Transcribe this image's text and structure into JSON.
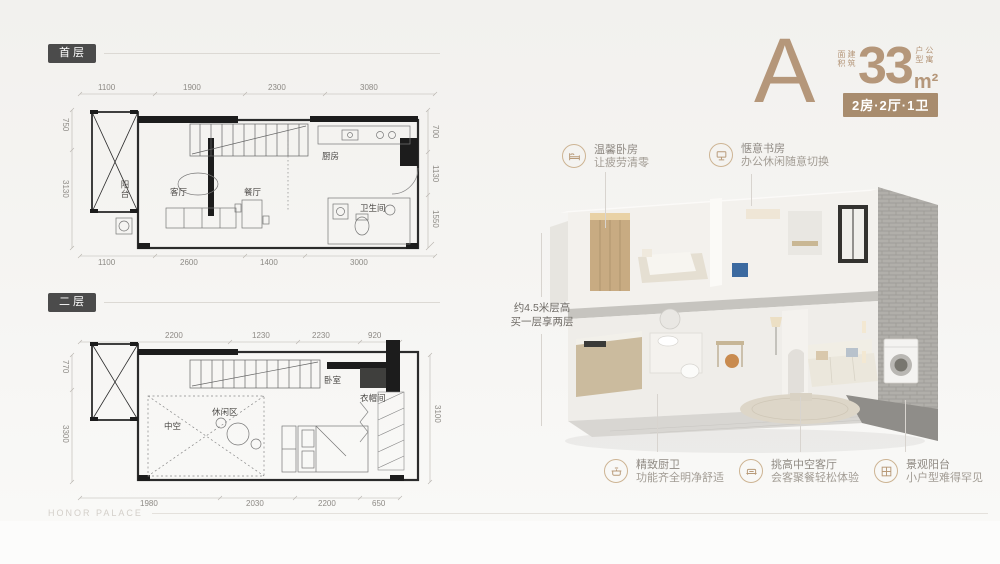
{
  "header": {
    "plan_letter": "A",
    "area_label_vertical": "建筑面积",
    "area_value": "33",
    "area_unit": "m²",
    "type_label_vertical": "公寓户型",
    "unit_badge": "2房·2厅·1卫"
  },
  "floor_plans": [
    {
      "badge": "首层",
      "room_labels": {
        "balcony": "阳台",
        "living": "客厅",
        "dining": "餐厅",
        "kitchen": "厨房",
        "bath": "卫生间"
      },
      "dims_top": [
        "1100",
        "1900",
        "2300",
        "3080"
      ],
      "dims_bottom": [
        "1100",
        "2600",
        "1400",
        "3000"
      ],
      "dims_left": [
        "750",
        "3130"
      ],
      "dims_right": [
        "700",
        "1130",
        "1550"
      ]
    },
    {
      "badge": "二层",
      "room_labels": {
        "void": "中空",
        "leisure": "休闲区",
        "bedroom": "卧室",
        "cloak": "衣帽间"
      },
      "dims_top": [
        "2200",
        "1230",
        "2230",
        "920"
      ],
      "dims_bottom": [
        "1980",
        "2030",
        "2200",
        "650"
      ],
      "dims_left": [
        "770",
        "3300"
      ],
      "dims_right": [
        "3100"
      ]
    }
  ],
  "center_note": {
    "line1": "约4.5米层高",
    "line2": "买一层享两层"
  },
  "callouts": [
    {
      "icon": "bed-icon",
      "title": "温馨卧房",
      "desc": "让疲劳清零"
    },
    {
      "icon": "study-icon",
      "title": "惬意书房",
      "desc": "办公休闲随意切换"
    },
    {
      "icon": "kitchen-icon",
      "title": "精致厨卫",
      "desc": "功能齐全明净舒适"
    },
    {
      "icon": "sofa-icon",
      "title": "挑高中空客厅",
      "desc": "会客聚餐轻松体验"
    },
    {
      "icon": "window-icon",
      "title": "景观阳台",
      "desc": "小户型难得罕见"
    }
  ],
  "watermark": "HONOR PALACE",
  "colors": {
    "accent": "#b5977a",
    "unit_badge_bg": "#a88c6e",
    "floor_badge_bg": "#4b4b4b",
    "label_text": "#9c968e",
    "leader_line": "#d8d4cf"
  }
}
